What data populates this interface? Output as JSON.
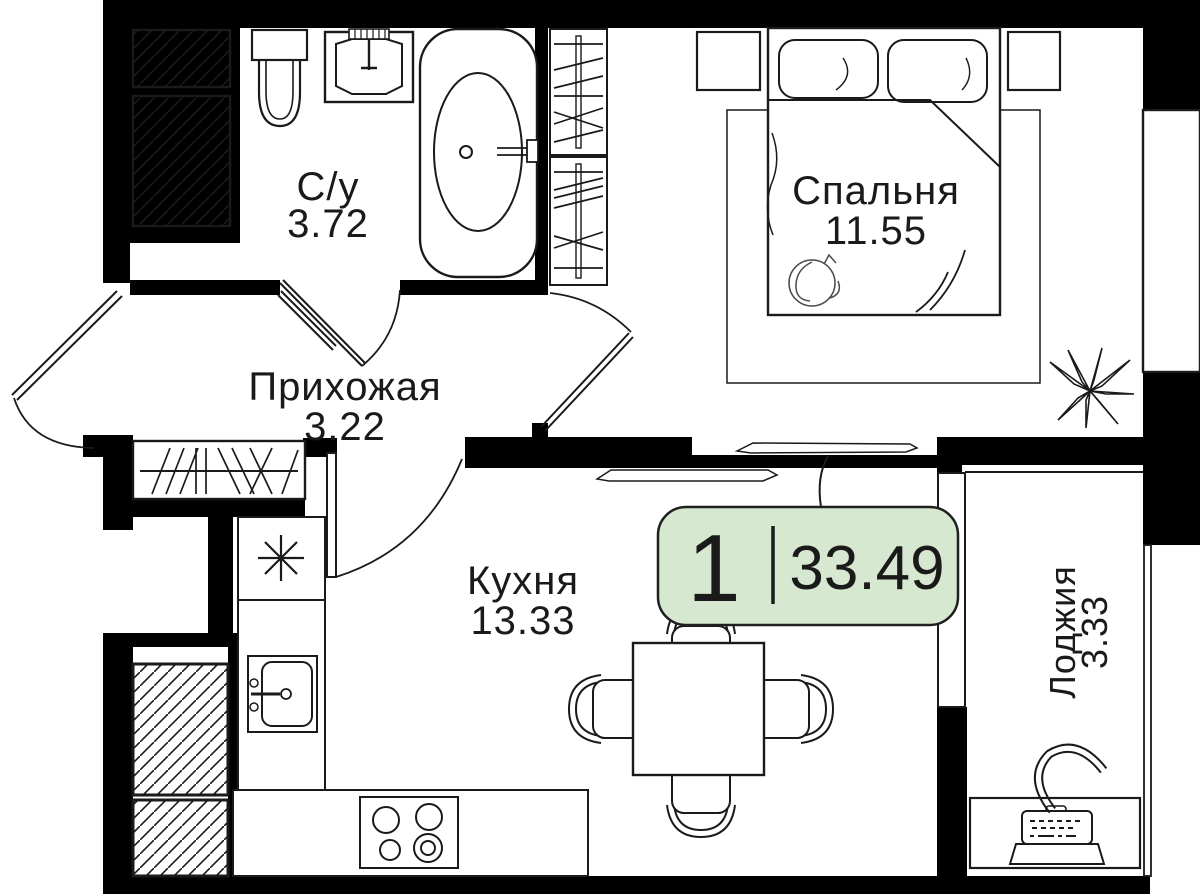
{
  "plan": {
    "badge": {
      "rooms_count": "1",
      "total_area": "33.49"
    },
    "rooms": {
      "bathroom": {
        "name": "С/у",
        "area": "3.72"
      },
      "hallway": {
        "name": "Прихожая",
        "area": "3.22"
      },
      "bedroom": {
        "name": "Спальня",
        "area": "11.55"
      },
      "kitchen": {
        "name": "Кухня",
        "area": "13.33"
      },
      "loggia": {
        "name": "Лоджия",
        "area": "3.33"
      }
    },
    "colors": {
      "wall": "#000000",
      "badge_fill": "#d7e8d0",
      "badge_border": "#1f1f1f",
      "rug_fill": "#ebebeb",
      "line": "#1a1a1a"
    },
    "symbols": {
      "fridge": "✳"
    }
  }
}
